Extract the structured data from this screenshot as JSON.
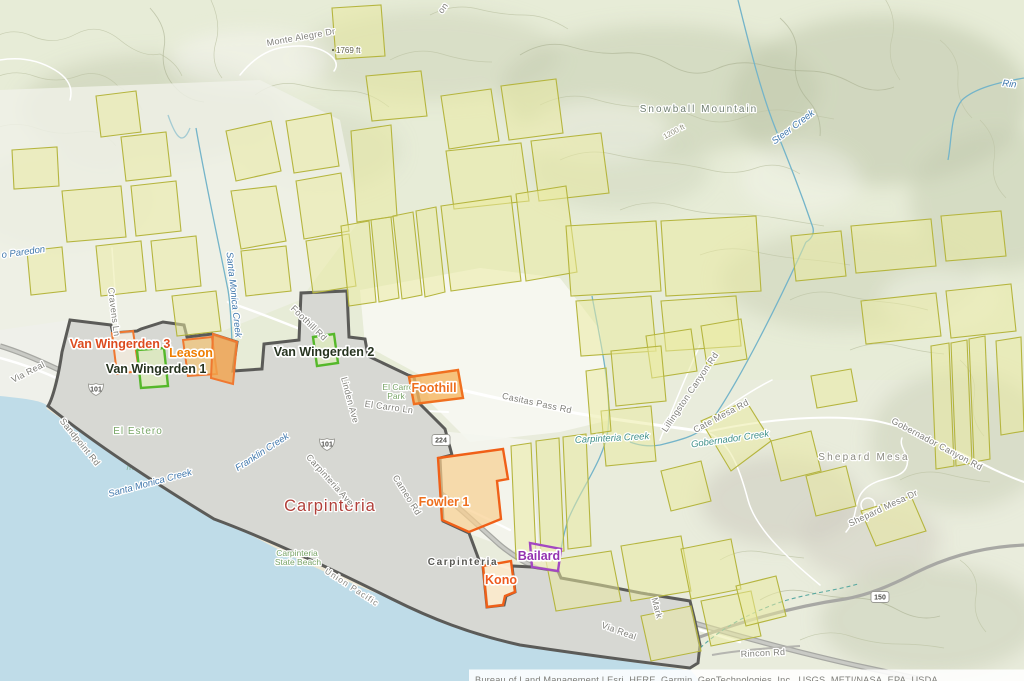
{
  "map": {
    "attribution": "Bureau of Land Management | Esri, HERE, Garmin, GeoTechnologies, Inc., USGS, METI/NASA, EPA, USDA",
    "city_labels": {
      "carpinteria": "Carpinteria",
      "carpinteria_small": "Carpinteria"
    },
    "terrain_labels": {
      "mountain": "Snowball Mountain",
      "mesa": "Shepard Mesa",
      "elev_1769": "1769 ft",
      "elev_1200": "1200 ft"
    },
    "sites": [
      {
        "label": "Van Wingerden 3",
        "color": "#dd4b1f"
      },
      {
        "label": "Leason",
        "color": "#ef7d00"
      },
      {
        "label": "Van Wingerden 1",
        "color": "#26331f"
      },
      {
        "label": "Van Wingerden 2",
        "color": "#26331f"
      },
      {
        "label": "Foothill",
        "color": "#ee6f1e"
      },
      {
        "label": "Fowler 1",
        "color": "#ee6f1e"
      },
      {
        "label": "Bailard",
        "color": "#9432b0"
      },
      {
        "label": "Kono",
        "color": "#ee5a1e"
      }
    ],
    "streets": [
      "Monte Alegre Dr",
      "Via Real",
      "Sandpoint Rd",
      "Cravens Ln",
      "Linden Ave",
      "El Carro Ln",
      "Casitas Pass Rd",
      "Carpinteria Ave",
      "Cameo Rd",
      "Foothill Rd",
      "Lillingston Canyon Rd",
      "Cate Mesa Rd",
      "Gobernador Canyon Rd",
      "Shepard Mesa Dr",
      "Via Real",
      "Rincon Rd",
      "Mark",
      "on"
    ],
    "railroad": "Union Pacific",
    "creeks": [
      "Santa Monica Creek",
      "Franklin Creek",
      "Carpinteria Creek",
      "Gobernador Creek",
      "Steer Creek",
      "o Paredon",
      "Rin"
    ],
    "parks": {
      "estero": "El Estero",
      "carro_1": "El Carro",
      "carro_2": "Park",
      "beach_1": "Carpinteria",
      "beach_2": "State Beach"
    },
    "shields": {
      "us101": "101",
      "ca224": "224",
      "ca150": "150"
    }
  }
}
